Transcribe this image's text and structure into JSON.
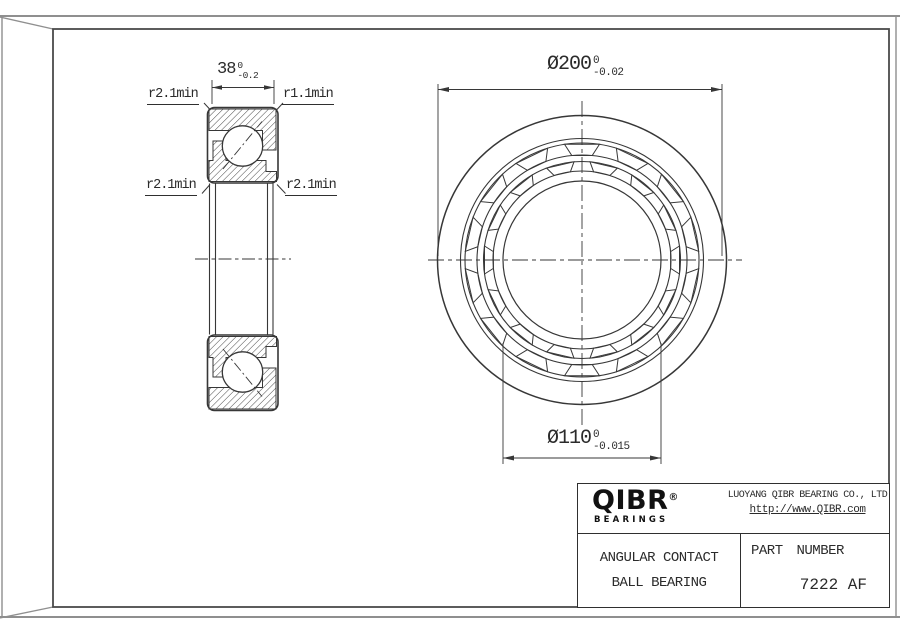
{
  "side_view": {
    "width_dim": {
      "value": "38",
      "tol_upper": "0",
      "tol_lower": "-0.2"
    },
    "label_top_left": "r2.1min",
    "label_top_right": "r1.1min",
    "label_bottom_left": "r2.1min",
    "label_bottom_right": "r2.1min"
  },
  "front_view": {
    "outer_dim": {
      "value": "Ø200",
      "tol_upper": "0",
      "tol_lower": "-0.02"
    },
    "bore_dim": {
      "value": "Ø110",
      "tol_upper": "0",
      "tol_lower": "-0.015"
    }
  },
  "title_block": {
    "logo_brand": "QIBR",
    "logo_registered": "®",
    "logo_subtitle": "BEARINGS",
    "company_name": "LUOYANG QIBR BEARING CO., LTD",
    "website": "http://www.QIBR.com",
    "product_type_line1": "ANGULAR CONTACT",
    "product_type_line2": "BALL BEARING",
    "part_number_label": "PART NUMBER",
    "part_number": "7222 AF"
  },
  "colors": {
    "line": "#373737",
    "frame_outer": "#8f8f8f",
    "frame_inner": "#4a4a4a"
  }
}
